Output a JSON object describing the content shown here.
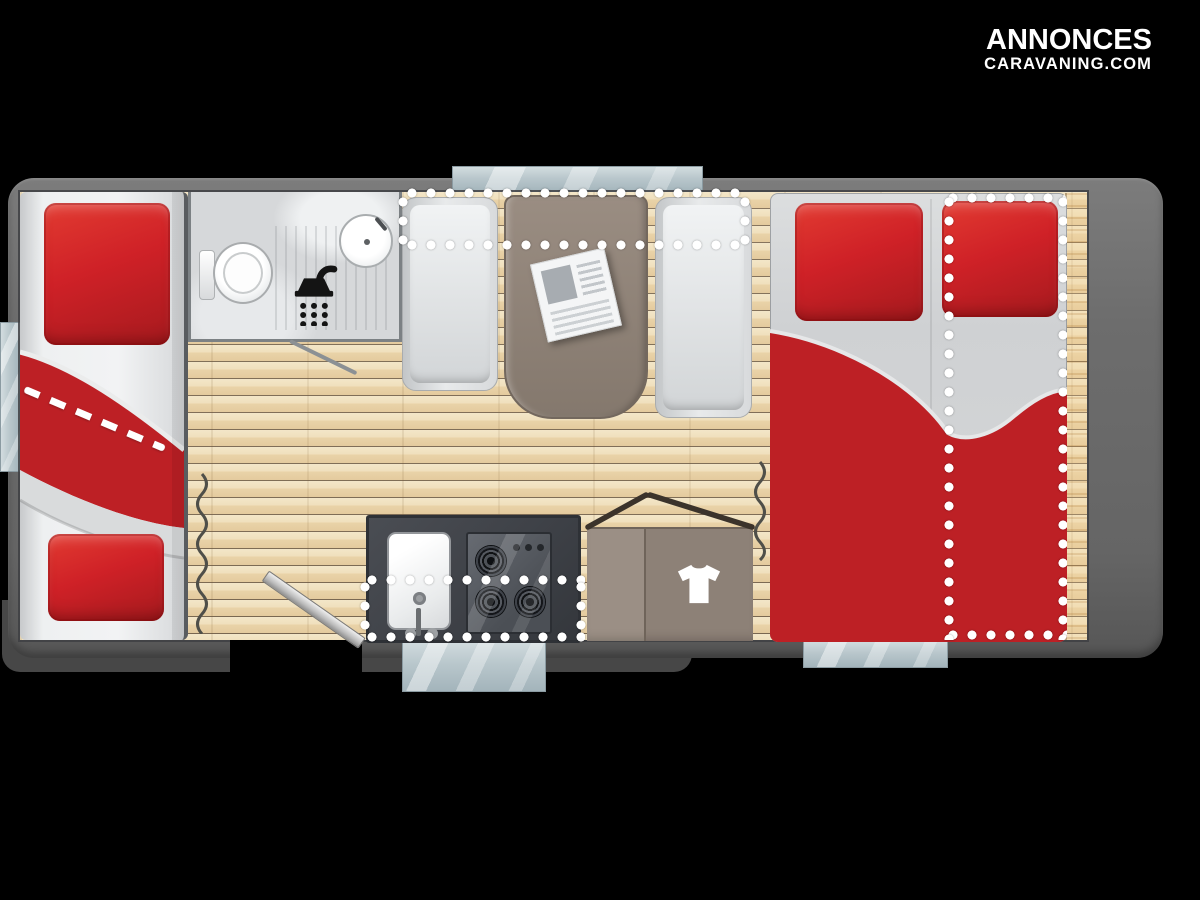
{
  "brand": {
    "line1": "ANNONCES",
    "line2": "CARAVANING.COM"
  },
  "floorplan": {
    "zones": [
      "bunk-beds",
      "bathroom",
      "dinette",
      "kitchen",
      "wardrobe",
      "double-bed"
    ],
    "fixtures": [
      "toilet",
      "washbasin",
      "shower",
      "kitchen-sink",
      "gas-hob-3-burners",
      "dinette-table",
      "newspaper",
      "wardrobe-tshirt",
      "entry-door",
      "window-tabs",
      "curtains",
      "bed-conversion-dotted-outlines"
    ],
    "icons": [
      "shower-icon",
      "tshirt-icon"
    ],
    "colors": {
      "bedding_red": "#c22025",
      "floor_wood": "#ecd9b5",
      "shell_gray": "#6c6c6c",
      "glass_blue": "#b7c5cb",
      "counter_dark": "#42454b",
      "furniture_taupe": "#8d8177",
      "dots_white": "#ffffff",
      "background": "#000000"
    }
  }
}
